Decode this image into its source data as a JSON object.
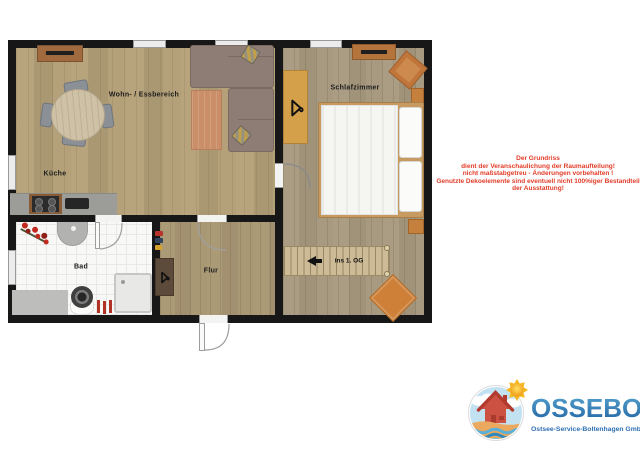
{
  "plan": {
    "rooms": {
      "living": {
        "label": "Wohn- / Essbereich"
      },
      "kitchen": {
        "label": "Küche"
      },
      "bedroom": {
        "label": "Schlafzimmer"
      },
      "bath": {
        "label": "Bad"
      },
      "hall": {
        "label": "Flur"
      }
    },
    "stairs": {
      "label": "ins 1. OG",
      "direction_icon": "arrow-left-icon"
    }
  },
  "disclaimer": {
    "lines": [
      "Der Grundriss",
      "dient der Veranschaulichung der Raumaufteilung!",
      "nicht maßstabgetreu - Änderungen vorbehalten !",
      "Genutzte Dekoelemente sind eventuell nicht 100%iger Bestandteil",
      "der Ausstattung!"
    ],
    "color": "#e23b28"
  },
  "logo": {
    "name": "OSSEBO",
    "subtitle": "Ostsee-Service-Boltenhagen GmbH",
    "emblem_icons": [
      "sun-icon",
      "house-icon",
      "cloud-icon",
      "waves-icon"
    ],
    "blue": "#2e6fb2",
    "gradient_top": "#55a3d0",
    "gradient_bottom": "#2465a3"
  },
  "icons": {
    "bedroom_wardrobe": "hanger-icon",
    "hall_coat_mat": "hanger-icon",
    "stairs_arrow": "arrow-left-icon"
  },
  "colors": {
    "wall": "#171717",
    "wood_living": "#b2a078",
    "wood_bedroom": "#a89a80",
    "bath_tile": "#f8f8f7",
    "accent_orange": "#cf8038",
    "kitchen_counter": "#9c9c98"
  }
}
